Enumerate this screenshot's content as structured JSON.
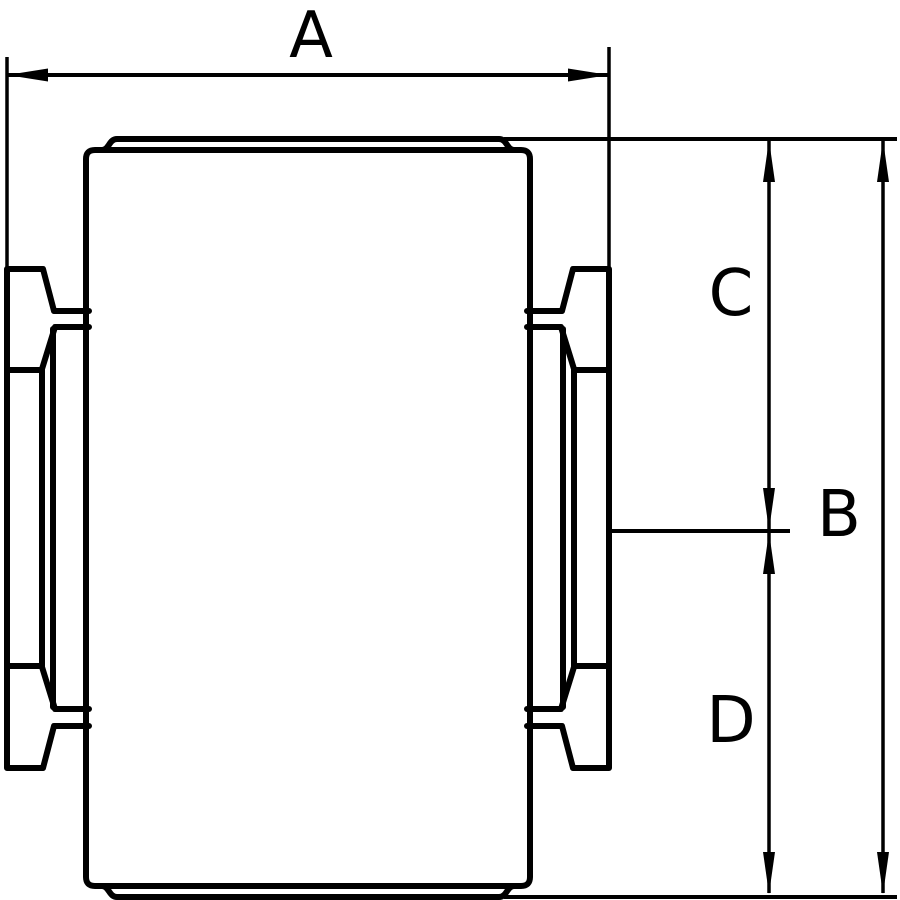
{
  "page": {
    "background_color": "#ffffff"
  },
  "drawing": {
    "type": "technical-dimension-drawing",
    "subject": "roller-with-side-hub-flanges-front-view",
    "line_color": "#000000",
    "labels": {
      "A": "A",
      "B": "B",
      "C": "C",
      "D": "D"
    },
    "dimensions": [
      {
        "label": "A",
        "orientation": "horizontal"
      },
      {
        "label": "C",
        "orientation": "vertical"
      },
      {
        "label": "B",
        "orientation": "vertical"
      },
      {
        "label": "D",
        "orientation": "vertical"
      },
      {
        "label": "",
        "orientation": "vertical"
      }
    ]
  }
}
